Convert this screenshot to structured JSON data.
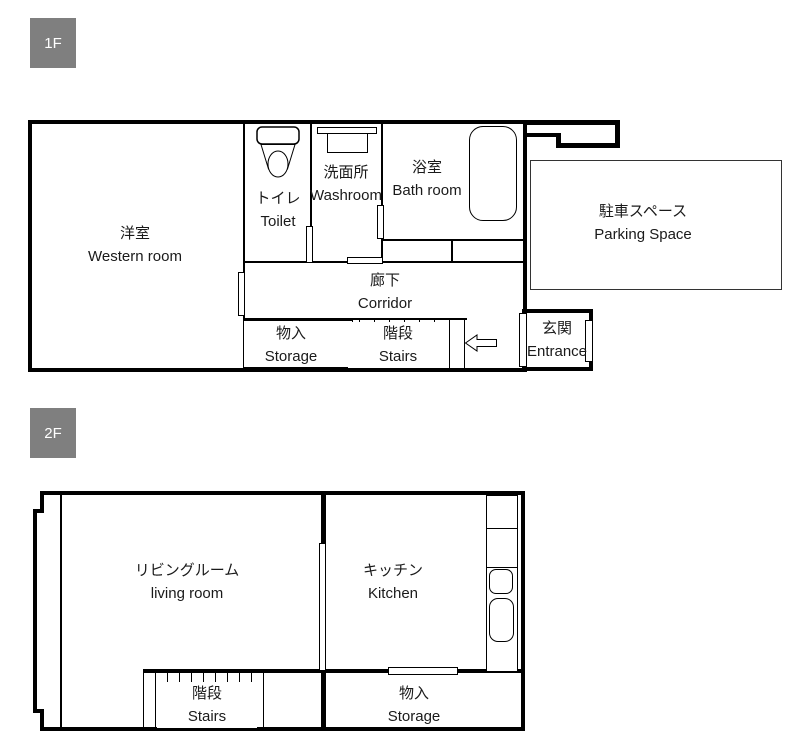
{
  "colors": {
    "wall": "#000000",
    "western_room_fill": "#eaf1ea",
    "floor_tag_bg": "#7f7f7f",
    "floor_tag_text": "#ffffff",
    "text": "#1a1a1a"
  },
  "floor1": {
    "tag": "1F",
    "rooms": {
      "western": {
        "jp": "洋室",
        "en": "Western room"
      },
      "toilet": {
        "jp": "トイレ",
        "en": "Toilet"
      },
      "washroom": {
        "jp": "洗面所",
        "en": "Washroom"
      },
      "bath": {
        "jp": "浴室",
        "en": "Bath room"
      },
      "parking": {
        "jp": "駐車スペース",
        "en": "Parking Space"
      },
      "corridor": {
        "jp": "廊下",
        "en": "Corridor"
      },
      "storage": {
        "jp": "物入",
        "en": "Storage"
      },
      "stairs": {
        "jp": "階段",
        "en": "Stairs"
      },
      "entrance": {
        "jp": "玄関",
        "en": "Entrance"
      }
    },
    "icons": [
      "toilet-icon",
      "washbasin-icon",
      "bathtub-icon",
      "entry-direction-arrow-icon"
    ]
  },
  "floor2": {
    "tag": "2F",
    "rooms": {
      "living": {
        "jp": "リビングルーム",
        "en": "living room"
      },
      "kitchen": {
        "jp": "キッチン",
        "en": "Kitchen"
      },
      "stairs": {
        "jp": "階段",
        "en": "Stairs"
      },
      "storage": {
        "jp": "物入",
        "en": "Storage"
      }
    },
    "icons": [
      "kitchen-counter-icon",
      "kitchen-sink-small-icon",
      "kitchen-sink-large-icon"
    ]
  }
}
